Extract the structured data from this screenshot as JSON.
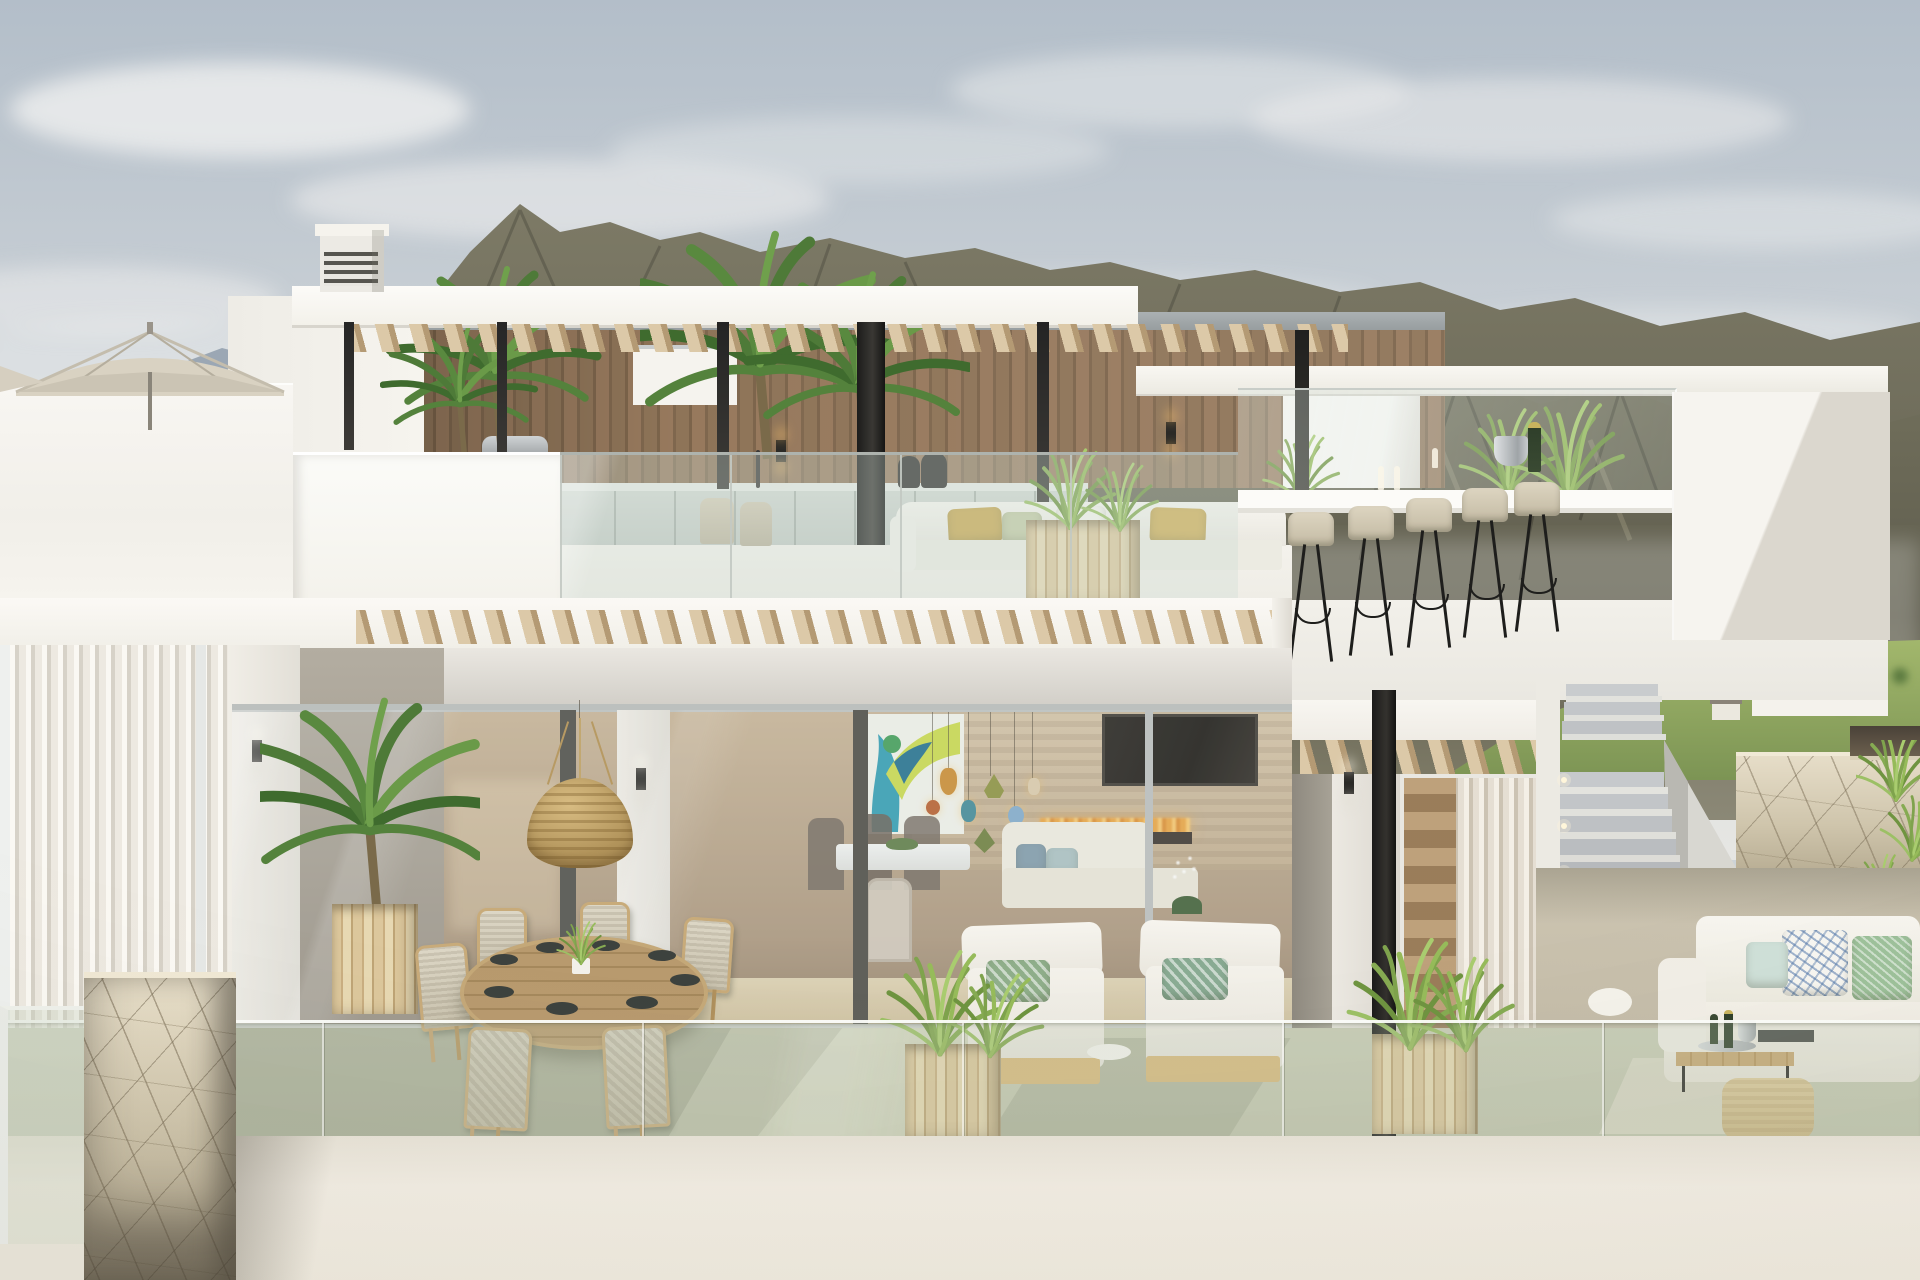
{
  "scene": {
    "type": "architectural-exterior-render",
    "description": "Daylight 3D rendering of a modern two-storey white luxury villa with rooftop terrace, glass balustrades and mountain backdrop",
    "sky": "pale blue-grey with soft clouds",
    "background": "layered scrub-covered mountain ridges, distant hillside houses, green golf hills at lower right",
    "labels": {
      "sky": "sky with soft clouds",
      "mountains": "mountain ridges backdrop",
      "green_hills": "green golf hills with trees and houses",
      "rooftop": "rooftop terrace with pergola, outdoor kitchen, lounge and bar",
      "pergola": "white pergola roof with wooden slats and black steel columns",
      "chimney": "white louvered chimney vent",
      "wood_wall": "vertical timber-clad wall of rooftop kitchen",
      "bbq": "stainless steel barbecue grill",
      "kitchen_counter": "outdoor kitchen counter with faucet and dark vases",
      "rooftop_sofa": "white outdoor sofa with gold and sage cushions",
      "bar": "glass-edged bar counter with champagne set and five beige bar stools",
      "umbrella": "beige patio parasol on left roof",
      "palms": "potted palm plants",
      "main_fascia": "white floor slab edge with angled timber brise-soleil rows",
      "interior": "open-plan interior with dining table, coloured glass pendants, abstract art, TV and linear fireplace",
      "wicker_lamp": "large woven wicker dome pendant over terrace dining table",
      "dining_set": "round plank-top dining table with dark plates and six wicker chairs",
      "lounges": "two white sun loungers with patterned green cushions",
      "planters": "cube timber planters with ornamental grasses",
      "stairs": "external staircase with step lights leading to roof terrace",
      "stone_wall": "cracked beige stone boundary wall with trailing greenery",
      "stone_pillar": "stone-clad pillar at lower left terrace corner",
      "right_sofa": "white corner sofa with patterned pillows, wooden coffee table, champagne tray and pouf",
      "balustrade": "frameless glass balustrade along terrace edge",
      "parapet": "plain off-white front parapet wall"
    },
    "counts": {
      "bar_stools": 5,
      "dining_chairs": 6,
      "sun_loungers": 2,
      "cube_planters": 2,
      "sawtooth_rows": 3
    }
  },
  "palette": {
    "sky_top": "#b3bec9",
    "sky_low": "#e2e3e1",
    "mountain_far": "#8f9dab",
    "mountain_main": "#6e6c5a",
    "mountain_shadow": "#55534a",
    "hill_green": "#8aa45e",
    "tree_green": "#5c7a40",
    "wall_white": "#f7f5f0",
    "wall_shade": "#d2cfc8",
    "wood_wall": "#8b7156",
    "pergola_slat": "#d9c7a7",
    "column_black": "#232322",
    "glass_tint": "#cfdcd4",
    "stool_seat": "#d4cbb6",
    "cushion_gold": "#c9a851",
    "cushion_sage": "#c4cba6",
    "terrace_floor": "#c7cab4",
    "floor_shadow": "#a3a792",
    "stone_beige": "#d9cfb8",
    "parapet": "#efeade",
    "wicker": "#c8ab70",
    "table_wood": "#b89a6e",
    "flame": "#e8a23f",
    "tv_black": "#1e1b17",
    "pendant_amber": "#c98a2e",
    "pendant_teal": "#3f8794",
    "pendant_olive": "#8a8f3c",
    "art_teal": "#2f9bb1",
    "art_lime": "#c8d84b",
    "lounge_green": "#8fae8a",
    "grass_green": "#7fa34d"
  }
}
